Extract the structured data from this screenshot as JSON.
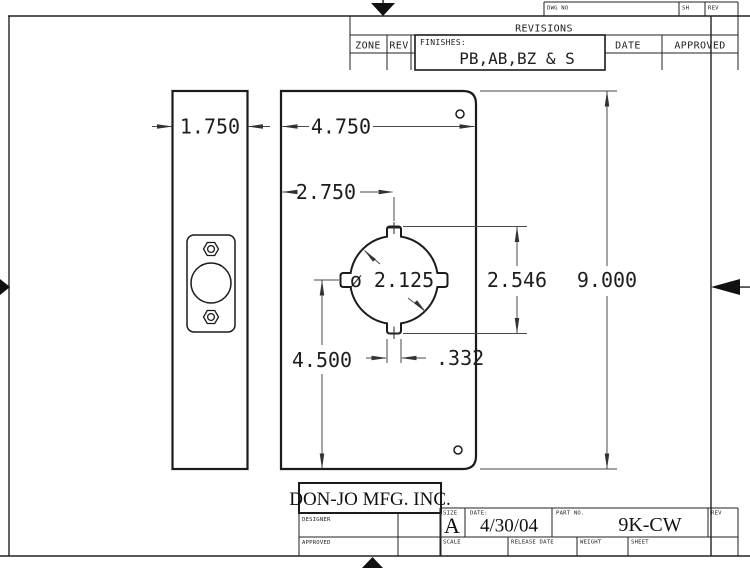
{
  "top_strip": {
    "dwg_no": "DWG NO",
    "sh": "SH",
    "rev": "REV"
  },
  "revisions": {
    "title": "REVISIONS",
    "zone": "ZONE",
    "rev": "REV",
    "finishes_label": "FINISHES:",
    "finishes_value": "PB,AB,BZ & S",
    "date": "DATE",
    "approved": "APPROVED"
  },
  "dims": {
    "side_width": "1.750",
    "plate_width": "4.750",
    "center_offset": "2.750",
    "bore_diameter": "ø 2.125",
    "notch_span": "2.546",
    "plate_height": "9.000",
    "center_height": "4.500",
    "notch_width": ".332"
  },
  "title_block": {
    "company": "DON-JO MFG. INC.",
    "designer_label": "DESIGNER",
    "approved_label": "APPROVED",
    "size_label": "SIZE",
    "size_value": "A",
    "date_label": "DATE:",
    "date_value": "4/30/04",
    "part_no_label": "PART NO.",
    "part_no_value": "9K-CW",
    "rev_label": "REV",
    "scale_label": "SCALE",
    "release_date_label": "RELEASE DATE",
    "weight_label": "WEIGHT",
    "sheet_label": "SHEET"
  }
}
